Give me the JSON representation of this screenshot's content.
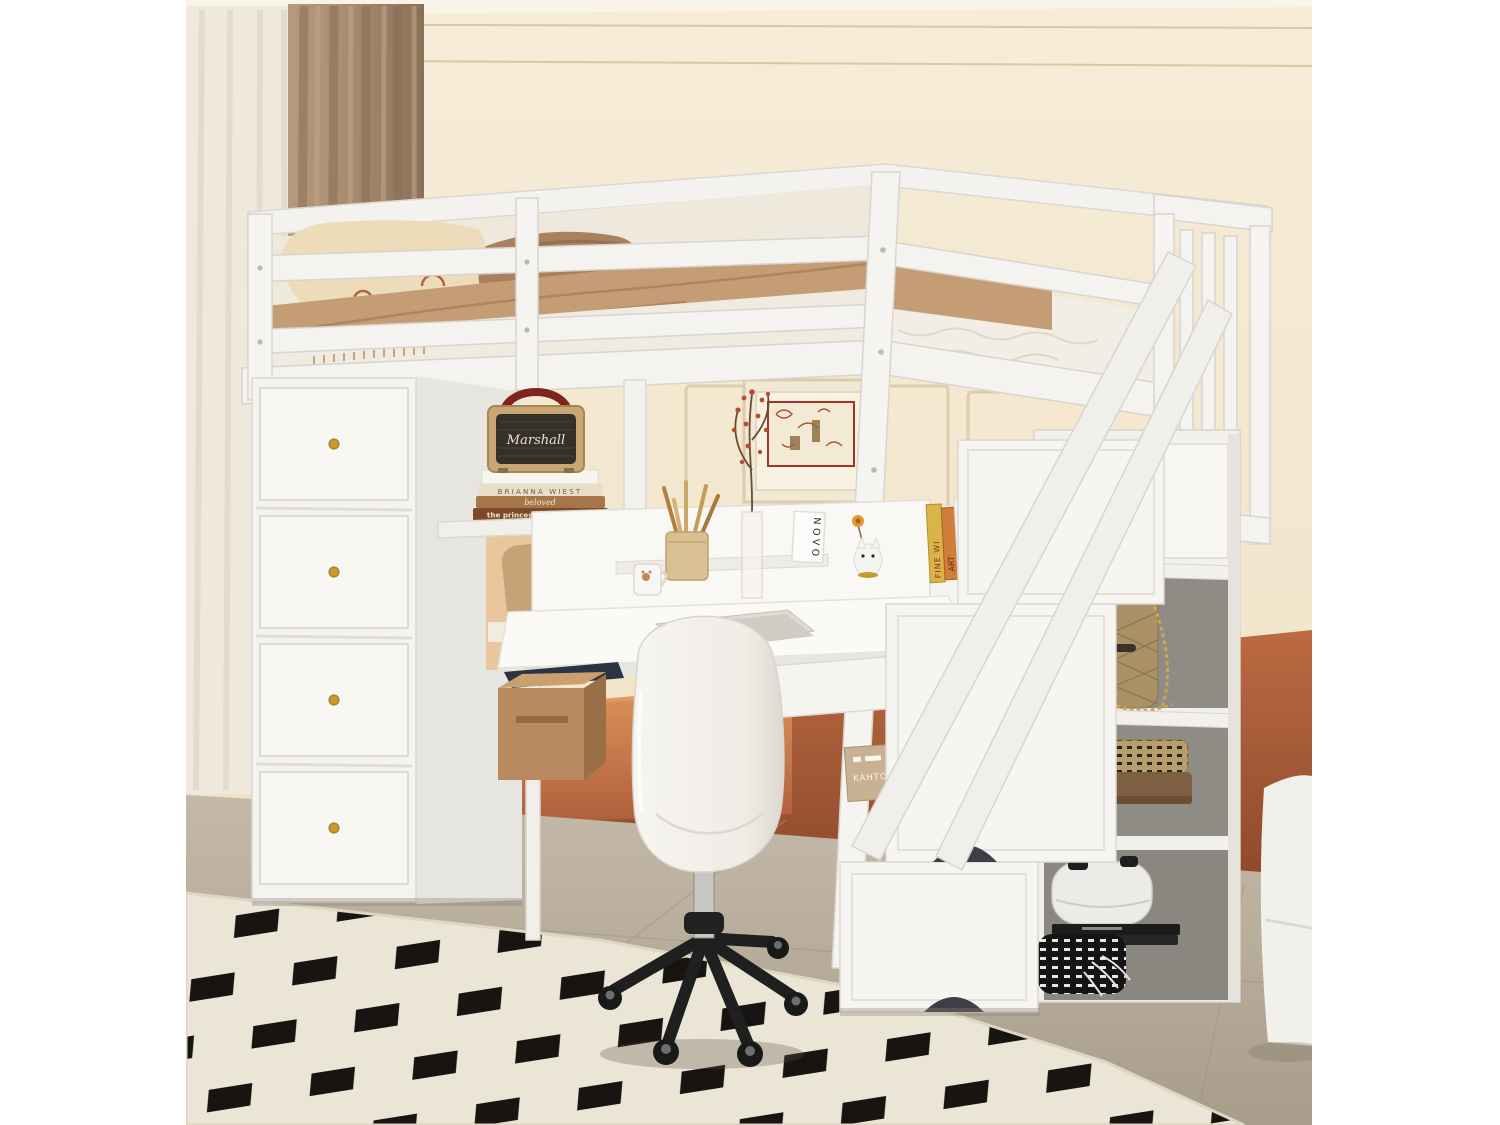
{
  "image": {
    "type": "product-photo",
    "subject": "White loft bed with storage staircase, drawer tower, desk, open shelves and swivel chair in a beige and terracotta kids bedroom",
    "canvas_background": "#ffffff"
  },
  "decor_text": {
    "speaker_brand": "Marshall",
    "book_spine_1": "BRIANNA WIEST",
    "book_spine_2": "beloved",
    "book_spine_3": "the princess saves herself",
    "desk_sign": "NOVO",
    "shelf_book_a": "FINE WI",
    "shelf_book_b": "ART",
    "storage_box_label": "KAHTO"
  },
  "colors": {
    "wall_cream": "#f2e5cc",
    "wall_terracotta": "#b2613e",
    "curtain_brown": "#a58a6e",
    "curtain_sheer": "#efe8dc",
    "floor_taupe": "#b7ab9a",
    "rug_cream": "#ebe5d6",
    "rug_black": "#171412",
    "furniture_white": "#f4f3f0",
    "bedding_tan": "#c49d75",
    "pillow_cream": "#ecdcba",
    "pillow_brown": "#a9815f",
    "chair_base_black": "#1f1f1f",
    "knob_gold": "#c59a2e",
    "speaker_tan": "#c9a774",
    "speaker_grille": "#35302a",
    "speaker_handle_red": "#7e241c"
  }
}
